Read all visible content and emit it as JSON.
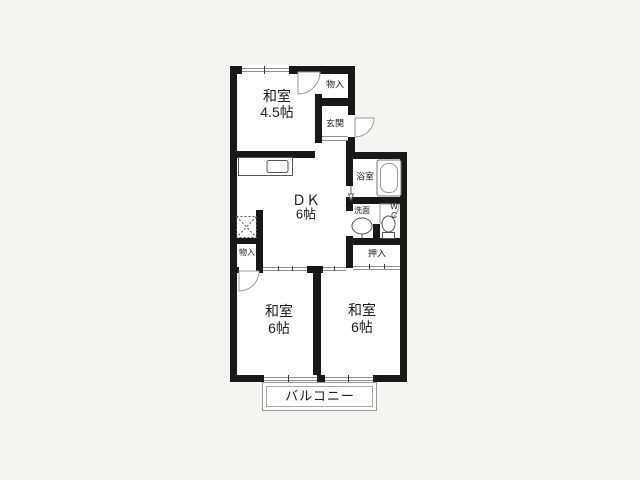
{
  "floorplan": {
    "type_note": "2DK apartment floor plan",
    "labels": {
      "washitsu45": {
        "line1": "和室",
        "line2": "4.5帖"
      },
      "monoire_top": "物入",
      "genkan": "玄関",
      "bathroom": "浴室",
      "dk": {
        "line1": "ＤＫ",
        "line2": "6帖"
      },
      "washroom": "洗面",
      "wc": {
        "line1": "W",
        "line2": "C"
      },
      "monoire_bottom": "物入",
      "oshiire": "押入",
      "washitsu_left": {
        "line1": "和室",
        "line2": "6帖"
      },
      "washitsu_right": {
        "line1": "和室",
        "line2": "6帖"
      },
      "balcony": "バルコニー"
    },
    "colors": {
      "wall": "#181818",
      "background": "#f4f4f1",
      "room_fill": "#ffffff",
      "thin_line": "#8f8f8f"
    },
    "fixtures": [
      "kitchen-counter",
      "kitchen-sink",
      "refrigerator-space-dashed",
      "bathtub",
      "wash-basin",
      "toilet",
      "entry-door-arc",
      "room-door-arcs",
      "window-marks",
      "sliding-door-tracks"
    ]
  }
}
